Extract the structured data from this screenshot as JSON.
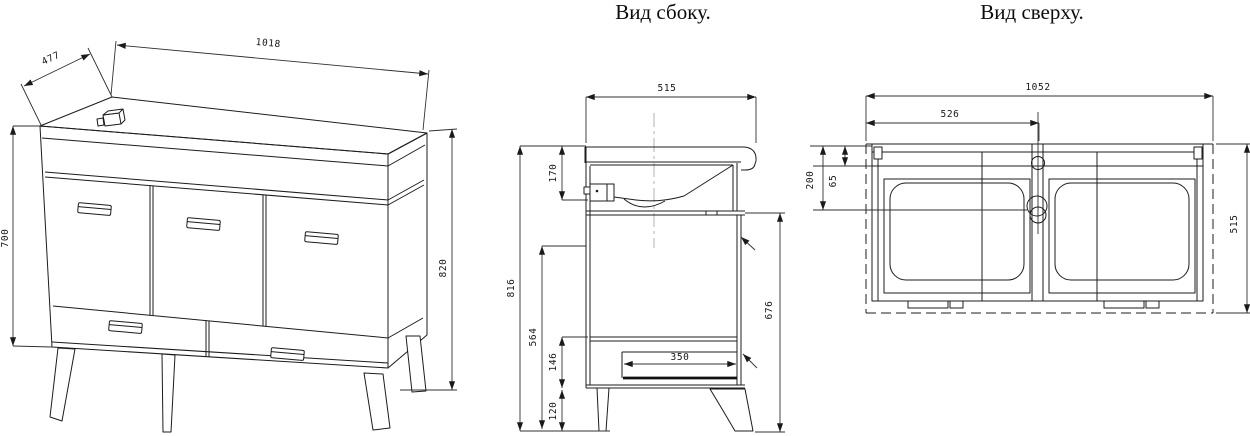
{
  "meta": {
    "background": "#ffffff",
    "line_color": "#1c1c1c",
    "drawing_type": "furniture technical drawing, washbasin vanity cabinet"
  },
  "views": {
    "front": {
      "name": "front perspective view",
      "dims": {
        "top_width": "1018",
        "depth": "477",
        "body_height": "700",
        "total_height": "820"
      }
    },
    "side": {
      "title": "Вид сбоку.",
      "dims": {
        "top_depth": "515",
        "sink_section": "170",
        "overall_height": "816",
        "lower_section": "564",
        "drawer_front": "146",
        "legs": "120",
        "drawer_depth": "350",
        "carcass_front": "676"
      }
    },
    "top": {
      "title": "Вид сверху.",
      "dims": {
        "countertop_width": "1052",
        "sink_center": "526",
        "back_rail": "65",
        "back_zone": "200",
        "countertop_depth": "515"
      }
    }
  }
}
